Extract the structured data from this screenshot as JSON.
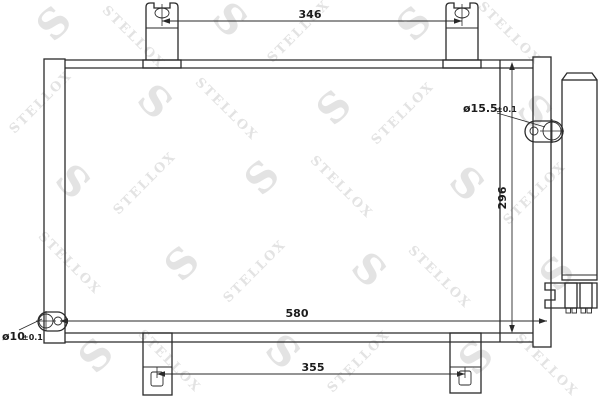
{
  "watermark": {
    "text": "STELLOX",
    "initial": "S"
  },
  "dimensions": {
    "top_width": "346",
    "overall_width": "580",
    "core_height": "296",
    "bottom_width": "355",
    "top_fitting": {
      "diameter": "ø15.5",
      "tolerance": "±0.1"
    },
    "bottom_fitting": {
      "diameter": "ø10",
      "tolerance": "±0.1"
    }
  },
  "colors": {
    "line": "#2a2a2a",
    "watermark": "#e3e3e3",
    "background": "#ffffff"
  }
}
